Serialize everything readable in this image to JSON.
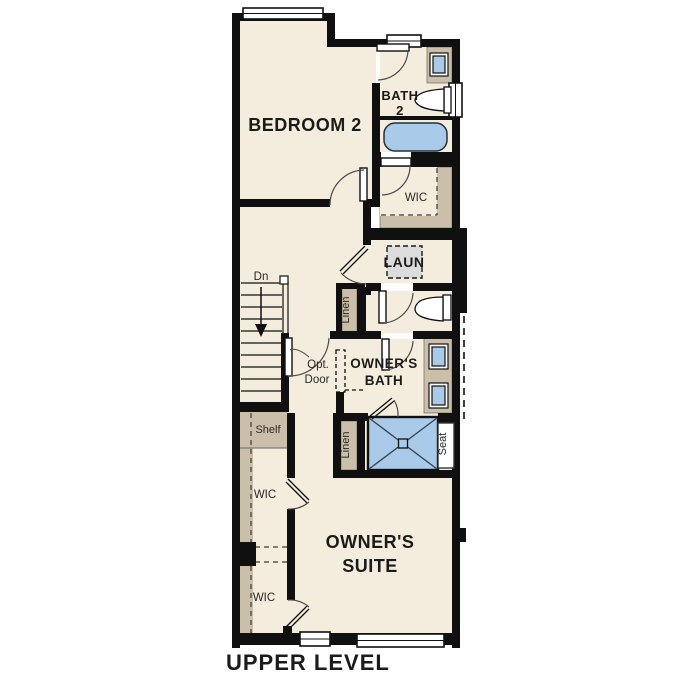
{
  "title": "UPPER LEVEL",
  "labels": {
    "bedroom2": "BEDROOM 2",
    "bath2_line1": "BATH",
    "bath2_line2": "2",
    "wic_top": "WIC",
    "laundry": "LAUN",
    "linen_upper": "Linen",
    "stairs_direction": "Dn",
    "optional_door_line1": "Opt.",
    "optional_door_line2": "Door",
    "owners_bath_line1": "OWNER'S",
    "owners_bath_line2": "BATH",
    "shelf": "Shelf",
    "linen_lower": "Linen",
    "seat": "Seat",
    "wic_middle": "WIC",
    "wic_lower": "WIC",
    "owners_suite_line1": "OWNER'S",
    "owners_suite_line2": "SUITE"
  },
  "colors": {
    "background": "#ffffff",
    "floor": "#f4ecdc",
    "wall": "#101010",
    "closet_tan": "#cbbfa9",
    "fixture_blue": "#a9cae8",
    "laundry_gray": "#dcdcdc",
    "door_arc": "#4a4a4a"
  }
}
